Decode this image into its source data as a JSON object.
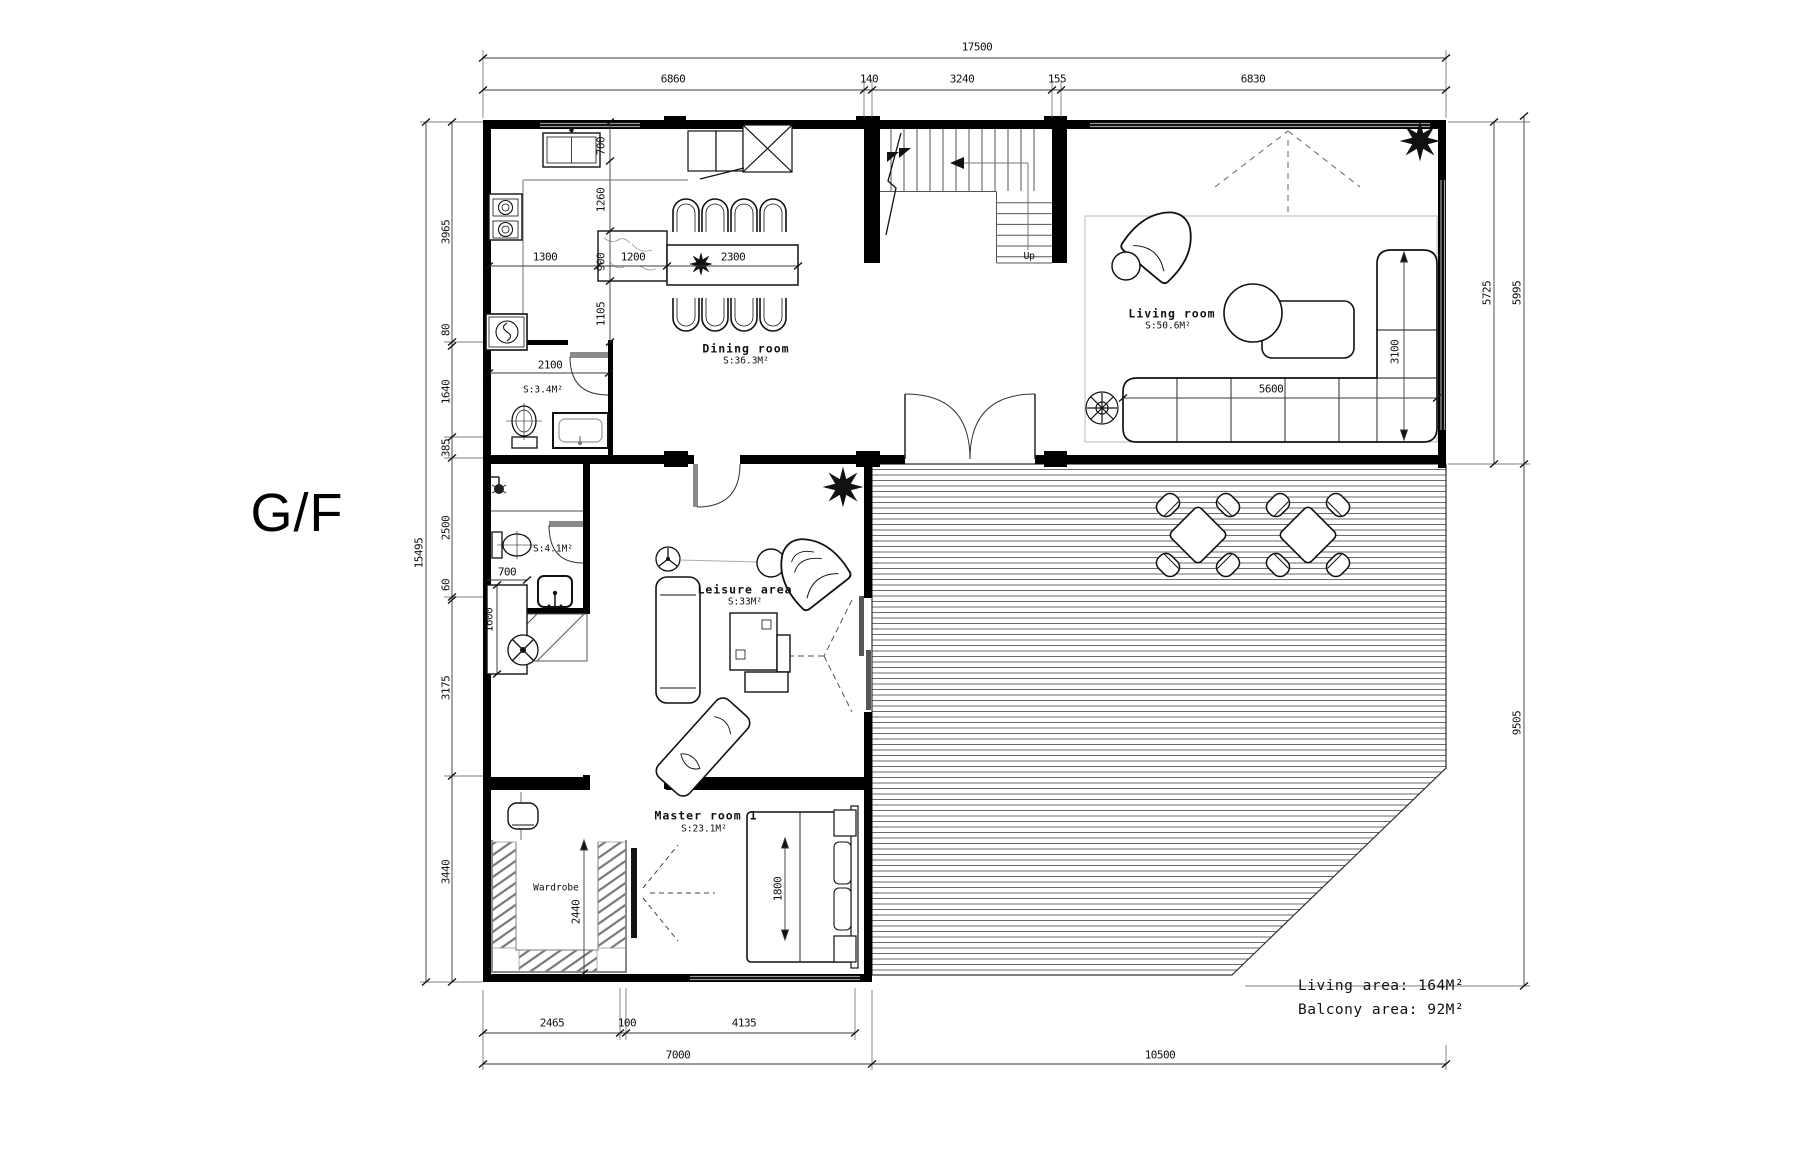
{
  "title": "G/F",
  "colors": {
    "line": "#111111",
    "dim": "#3a3a3a",
    "gray": "#888888",
    "deck_hatch": "#6a6a6a",
    "background": "#ffffff"
  },
  "rooms": {
    "dining": {
      "name": "Dining room",
      "area": "S:36.3M²"
    },
    "living": {
      "name": "Living room",
      "area": "S:50.6M²"
    },
    "leisure": {
      "name": "Leisure area",
      "area": "S:33M²"
    },
    "master": {
      "name": "Master room 1",
      "area": "S:23.1M²"
    },
    "bath1": {
      "area": "S:3.4M²"
    },
    "bath2": {
      "area": "S:4.1M²"
    },
    "wardrobe": {
      "name": "Wardrobe"
    }
  },
  "stairs": {
    "up": "Up"
  },
  "dims": {
    "top_total": "17500",
    "top_chain": [
      "6860",
      "140",
      "3240",
      "155",
      "6830"
    ],
    "left_total": "15495",
    "left_chain": [
      "3965",
      "80",
      "1640",
      "385",
      "2500",
      "60",
      "3175",
      "3440"
    ],
    "right_upper_inner": "5725",
    "right_upper_outer": "5995",
    "right_lower": "9505",
    "bottom_chain": [
      "2465",
      "100",
      "4135"
    ],
    "bottom_totals": [
      "7000",
      "10500"
    ],
    "kitchen_vertical": [
      "700",
      "1260",
      "900",
      "1105"
    ],
    "kitchen_horizontal": [
      "1300",
      "1200",
      "2300"
    ],
    "bath1_width": "2100",
    "sofa_length": "5600",
    "sofa_depth": "3100",
    "desk_width": "700",
    "desk_length": "1600",
    "bed_width": "1800",
    "wardrobe_depth": "2440"
  },
  "summary": {
    "living_area": "Living area: 164M²",
    "balcony_area": "Balcony area: 92M²"
  }
}
